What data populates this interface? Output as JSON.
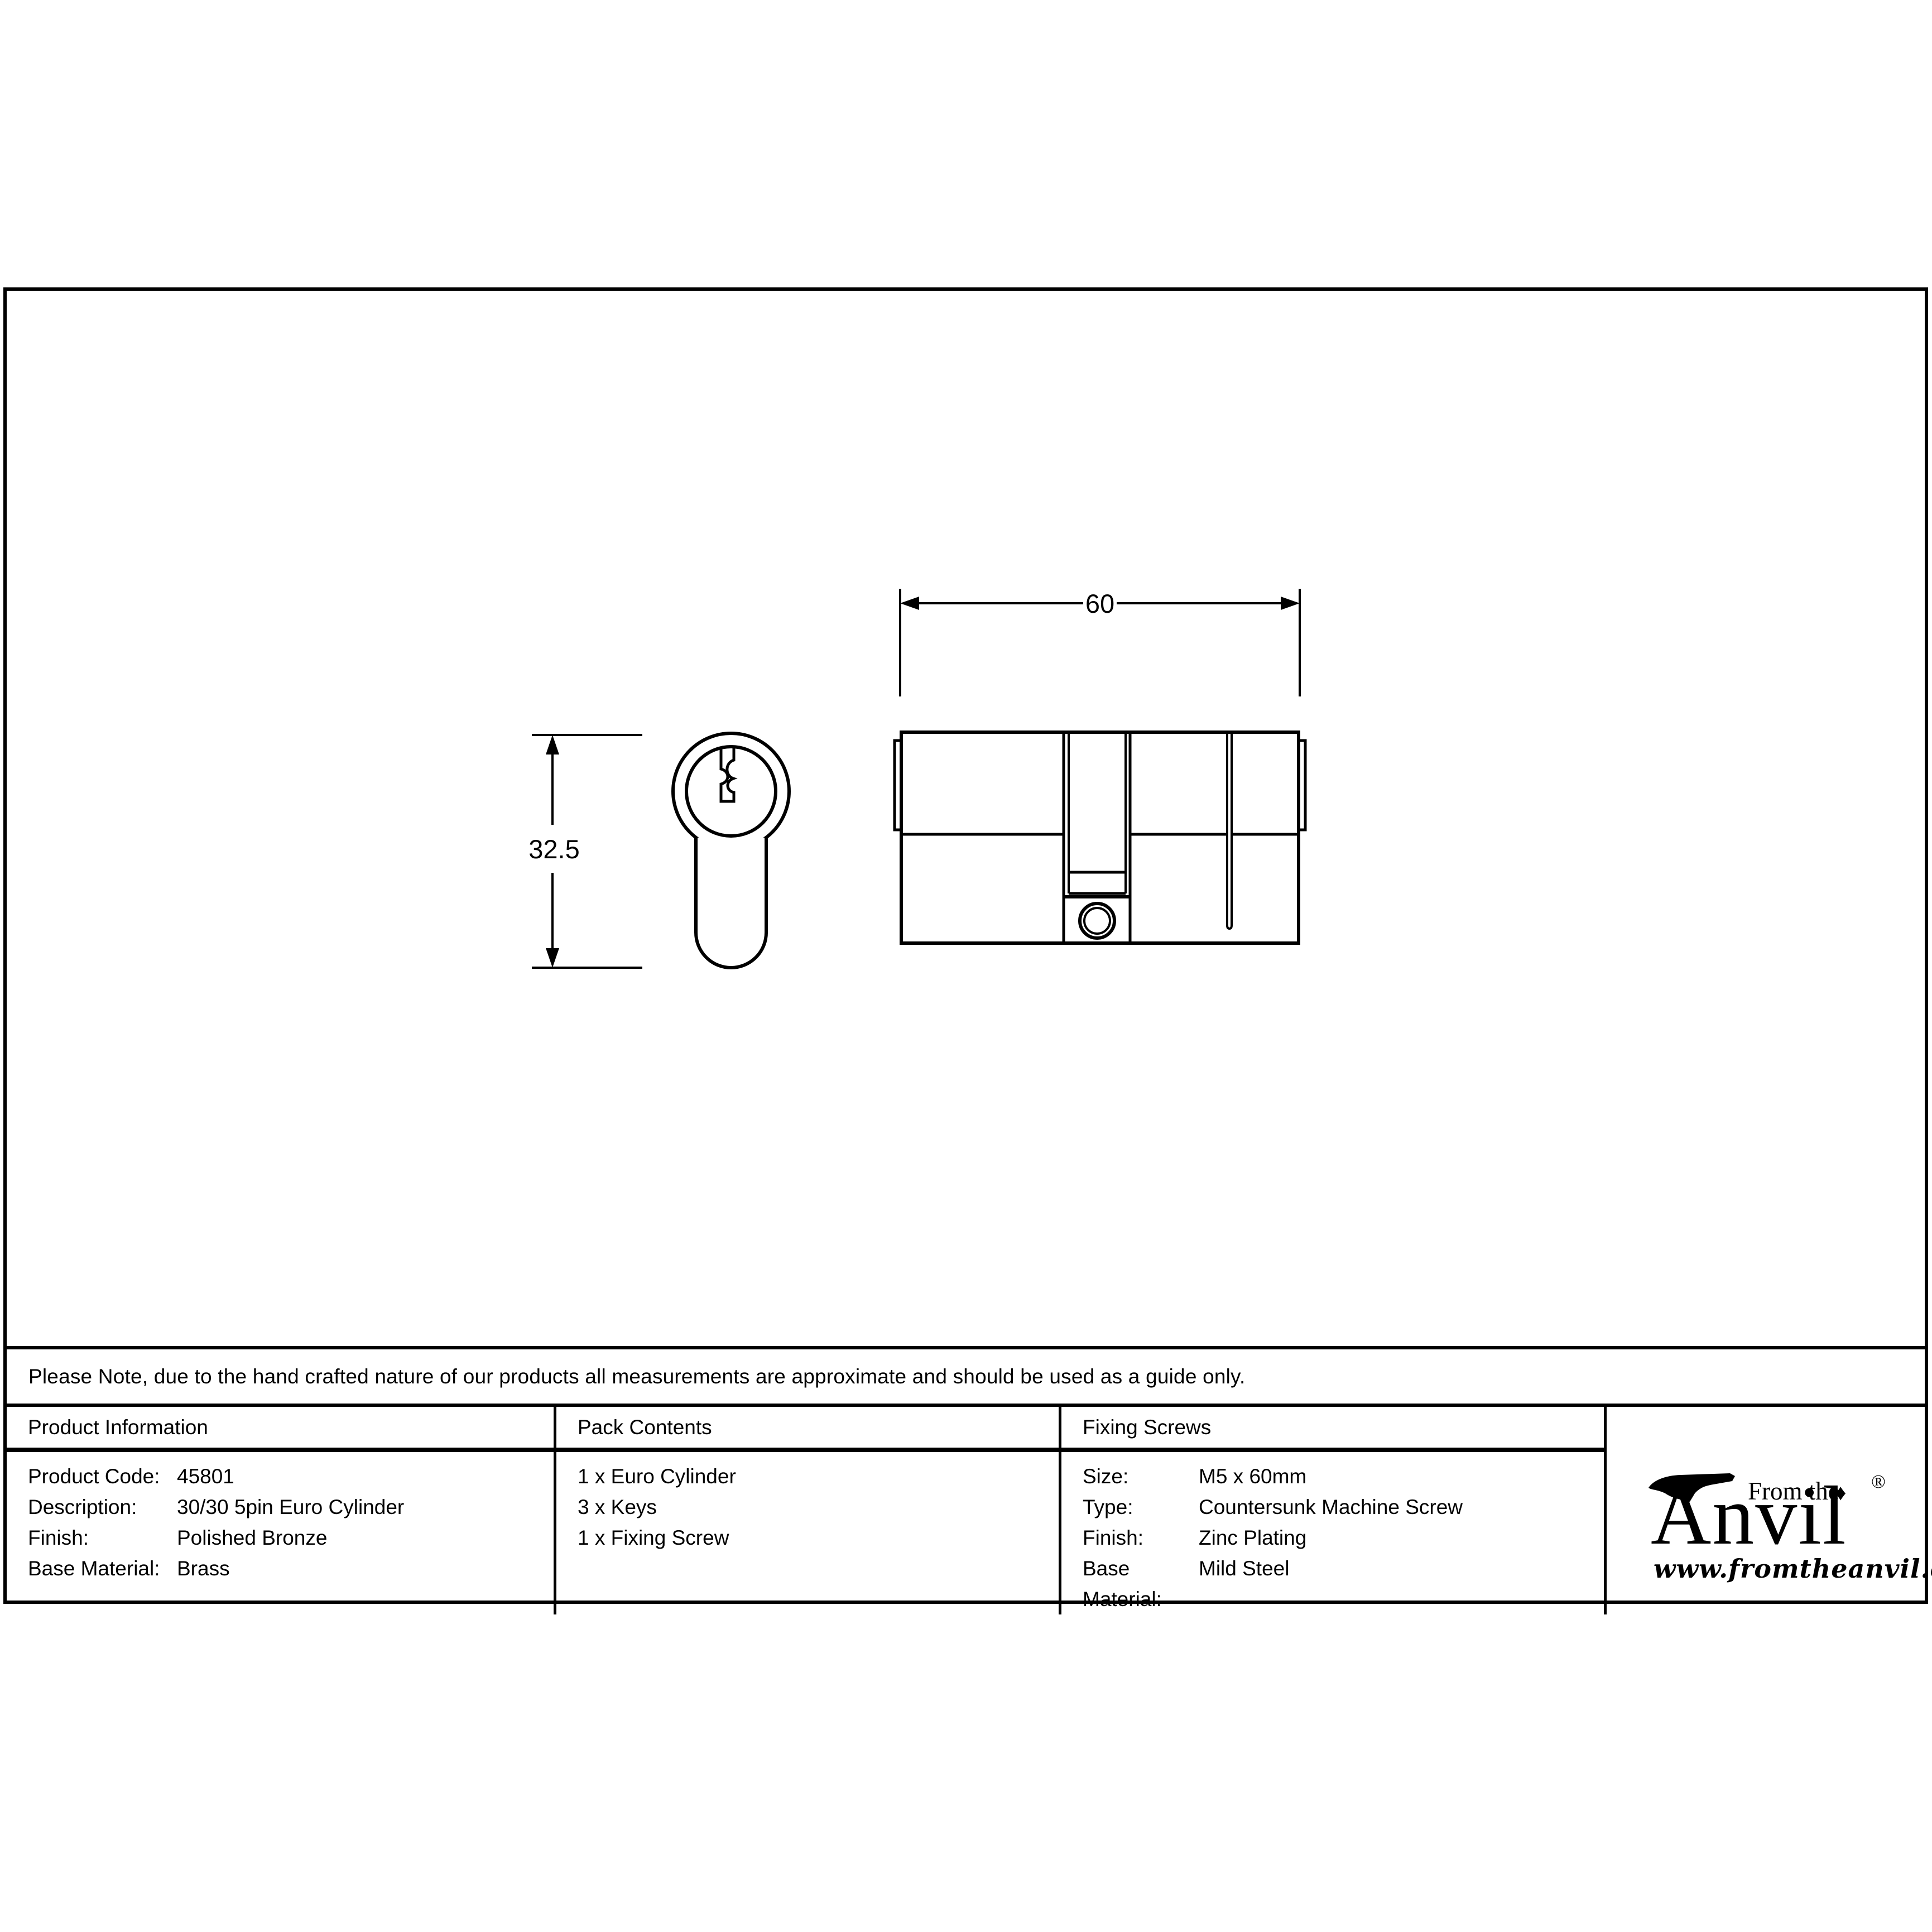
{
  "note": {
    "text": "Please Note, due to the hand crafted nature of our products all measurements are approximate and should be used as a guide only."
  },
  "drawing": {
    "width_dim_label": "60",
    "height_dim_label": "32.5"
  },
  "table": {
    "product_info": {
      "header": "Product Information",
      "rows": [
        {
          "label": "Product Code:",
          "value": "45801"
        },
        {
          "label": "Description:",
          "value": "30/30 5pin Euro Cylinder"
        },
        {
          "label": "Finish:",
          "value": "Polished Bronze"
        },
        {
          "label": "Base Material:",
          "value": "Brass"
        }
      ]
    },
    "pack_contents": {
      "header": "Pack Contents",
      "items": [
        "1 x Euro Cylinder",
        "3 x Keys",
        "1 x Fixing Screw"
      ]
    },
    "fixing_screws": {
      "header": "Fixing Screws",
      "rows": [
        {
          "label": "Size:",
          "value": "M5 x 60mm"
        },
        {
          "label": "Type:",
          "value": "Countersunk Machine Screw"
        },
        {
          "label": "Finish:",
          "value": "Zinc Plating"
        },
        {
          "label": "Base Material:",
          "value": "Mild Steel"
        }
      ]
    }
  },
  "logo": {
    "tagline": "From the",
    "name": "Anvil",
    "diamond": "♦",
    "registered": "®",
    "url": "www.fromtheanvil.co.uk"
  },
  "colors": {
    "ink": "#000000",
    "background": "#ffffff"
  }
}
